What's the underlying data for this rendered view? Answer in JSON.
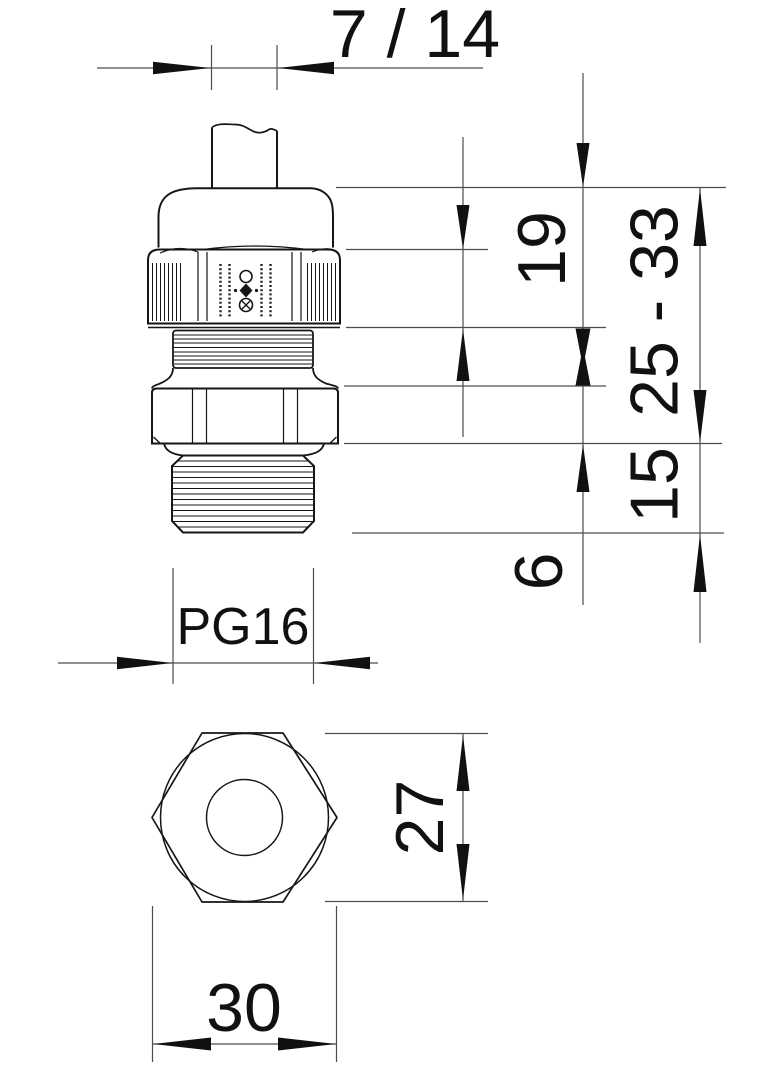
{
  "drawing": {
    "type": "technical-drawing-cable-gland",
    "colors": {
      "background": "#ffffff",
      "outline": "#161616",
      "dimension_lines": "#4d4d4d",
      "text": "#111111"
    },
    "dimensions": {
      "cable_diameter": "7 / 14",
      "cap_section_height": "19",
      "overall_height_range": "25 - 33",
      "body_section_height": "15",
      "thread_protrusion": "6",
      "thread_size": "PG16",
      "width_across_flats": "27",
      "width_across_corners": "30"
    }
  }
}
